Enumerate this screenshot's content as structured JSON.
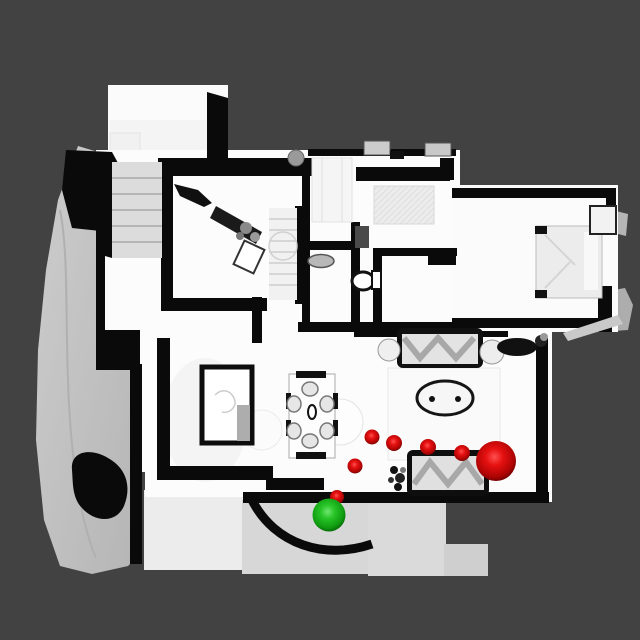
{
  "scene": {
    "kind": "top-down-3d-house-scan-render",
    "background_color": "#424242",
    "floor_color": "#fcfcfc",
    "wall_color": "#0a0a0a",
    "terrain_color": "#c3c3c3"
  },
  "waypoints": {
    "start_color": "#22c022",
    "path_color": "#e01212",
    "goal_color": "#e01212",
    "start": {
      "x": 329,
      "y": 515,
      "r": 16.5
    },
    "path": [
      {
        "x": 337,
        "y": 497,
        "r": 7
      },
      {
        "x": 355,
        "y": 466,
        "r": 7.5
      },
      {
        "x": 372,
        "y": 437,
        "r": 7.5
      },
      {
        "x": 394,
        "y": 443,
        "r": 8
      },
      {
        "x": 428,
        "y": 447,
        "r": 8
      },
      {
        "x": 462,
        "y": 453,
        "r": 8
      }
    ],
    "goal": {
      "x": 496,
      "y": 461,
      "r": 20
    }
  }
}
